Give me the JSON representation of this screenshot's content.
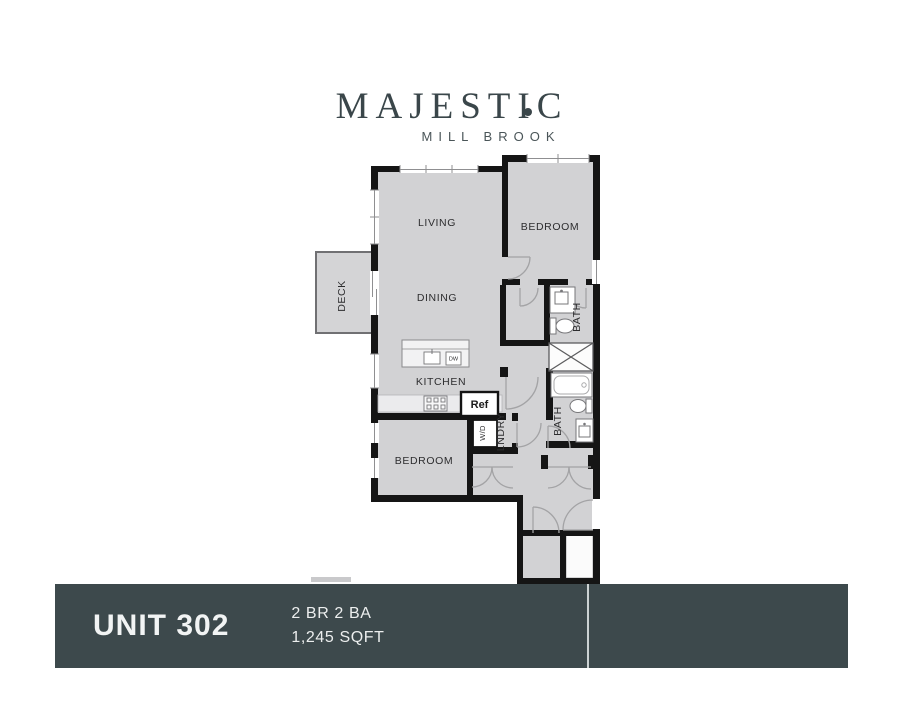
{
  "logo": {
    "title": "MAJESTIC",
    "subtitle": "MILL BROOK"
  },
  "floorplan": {
    "labels": {
      "living": "LIVING",
      "dining": "DINING",
      "kitchen": "KITCHEN",
      "bedroom1": "BEDROOM",
      "bedroom2": "BEDROOM",
      "deck": "DECK",
      "bath1": "BATH",
      "bath2": "BATH",
      "laundry": "LNDRY"
    },
    "fixtures": {
      "refrigerator": "Ref",
      "washer_dryer": "W/D",
      "dishwasher": "DW"
    }
  },
  "footer": {
    "unit": "UNIT 302",
    "bed_bath": "2 BR 2 BA",
    "area": "1,245 SQFT"
  },
  "colors": {
    "wall": "#151515",
    "room_fill": "#d2d2d4",
    "footer_bg": "#3d494c",
    "brand": "#3a464a"
  }
}
